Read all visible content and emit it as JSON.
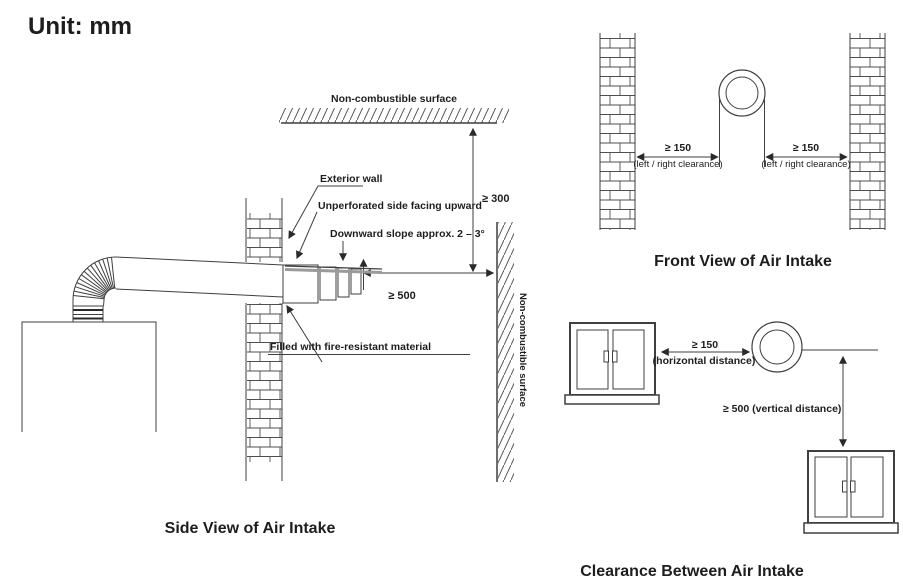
{
  "page": {
    "unit": "Unit: mm"
  },
  "colors": {
    "ink": "#1d1d1d",
    "line": "#3f3f3f"
  },
  "side_view": {
    "caption": "Side View of Air Intake",
    "top_surface": "Non-combustible surface",
    "right_surface": "Non-combustible surface",
    "exterior_wall": "Exterior wall",
    "unperforated": "Unperforated side facing upward",
    "slope": "Downward slope approx. 2 – 3°",
    "fire_material": "Filled with fire-resistant material",
    "clearance_top": "≥ 300",
    "clearance_right": "≥ 500"
  },
  "front_view": {
    "caption": "Front View of Air Intake",
    "left_clearance": "≥ 150",
    "left_clearance_note": "(left / right clearance)",
    "right_clearance": "≥ 150",
    "right_clearance_note": "(left / right clearance)"
  },
  "clearance_view": {
    "caption": "Clearance Between Air Intake",
    "horizontal_clearance": "≥ 150",
    "horizontal_note": "(horizontal distance)",
    "vertical_clearance": "≥ 500 (vertical distance)"
  }
}
